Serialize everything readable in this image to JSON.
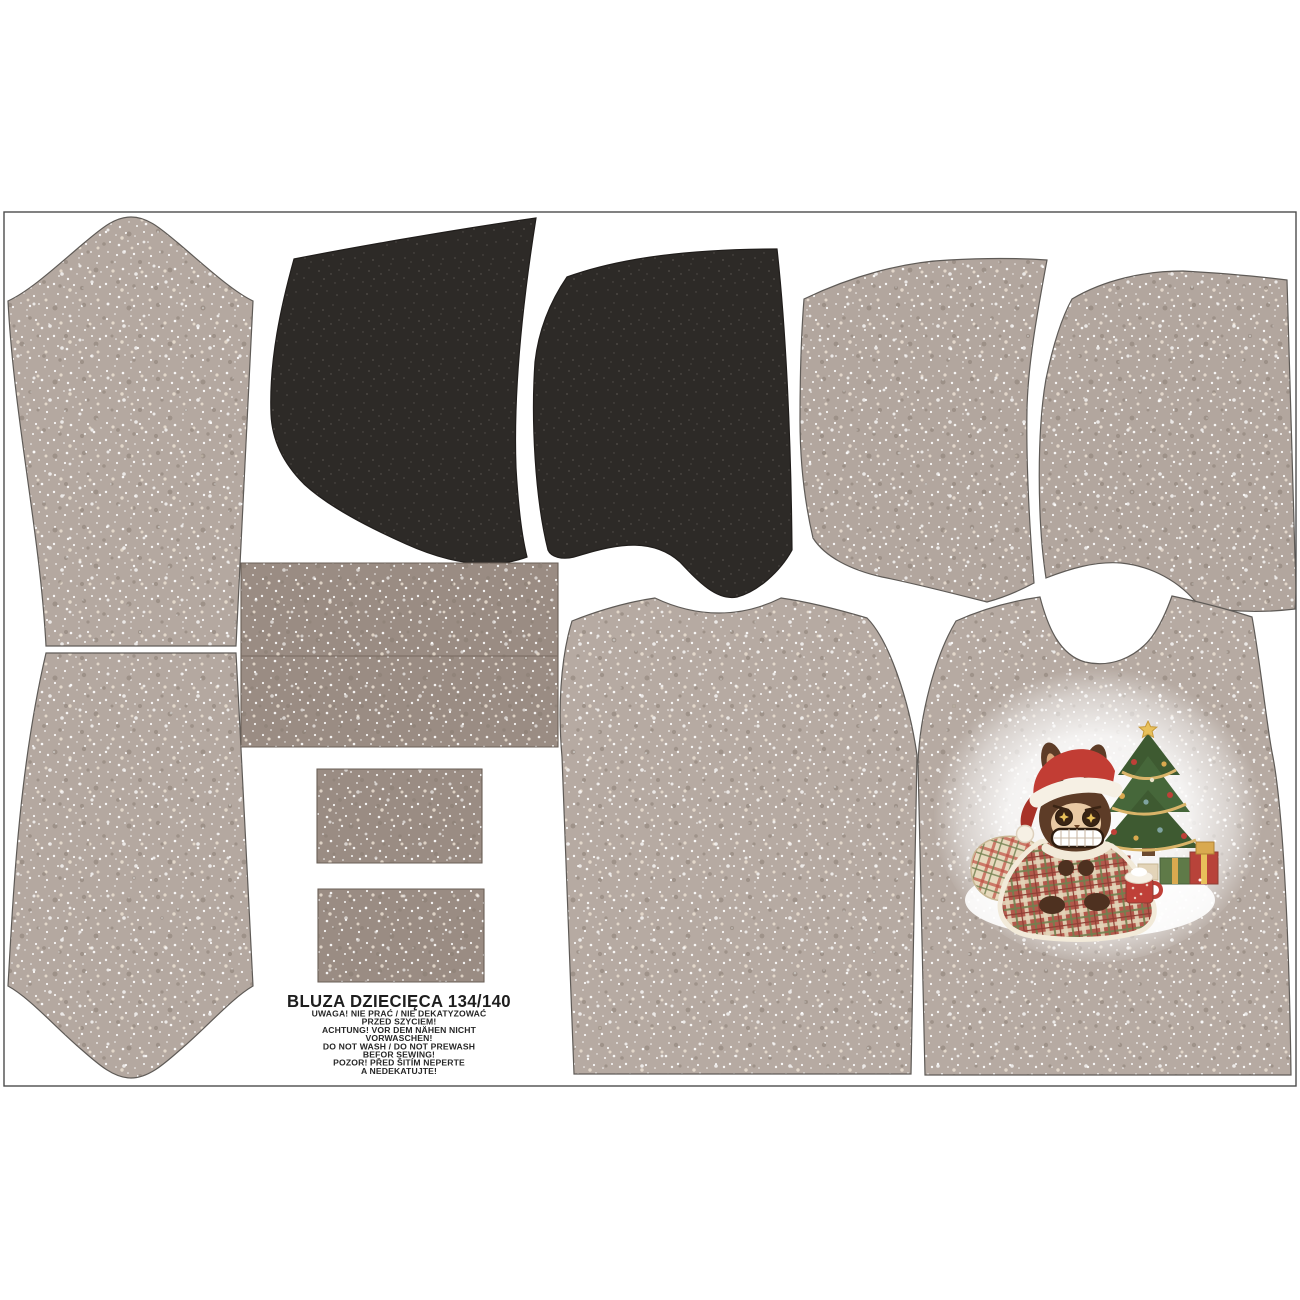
{
  "panel": {
    "label": {
      "title": "BLUZA DZIECIĘCA 134/140",
      "product_name": "BLUZA DZIECIĘCA",
      "size": "134/140",
      "care_lines": [
        "UWAGA! NIE PRAĆ / NIE DEKATYZOWAĆ",
        "PRZED SZYCIEM!",
        "ACHTUNG! VOR DEM NÄHEN NICHT",
        "VORWASCHEN!",
        "DO NOT WASH / DO NOT PREWASH",
        "BEFOR SEWING!",
        "POZOR! PŘED ŠITÍM NEPERTE",
        "A NEDEKATUJTE!"
      ]
    },
    "fabric_colors": {
      "speckled_beige": "#b4a8a0",
      "ribbing_taupe": "#9a8c83",
      "hood_dark_charcoal": "#2d2a27",
      "piece_outline": "#5f5b57",
      "frame_line": "#4c4c4c"
    },
    "print_colors": {
      "glow_white": "#ffffff",
      "santa_hat_red": "#c23d34",
      "fur_brown": "#5d3c27",
      "face_tan": "#e9c9a4",
      "tree_green": "#46673a",
      "garland_gold": "#d9b469",
      "blanket_red_plaid": "#b3594c",
      "pillow_cream_plaid": "#e7d9bd",
      "gift_red": "#b8433a",
      "gift_green": "#5f7a48",
      "gift_gold": "#d9a94f",
      "mug_red": "#bf4038"
    }
  }
}
